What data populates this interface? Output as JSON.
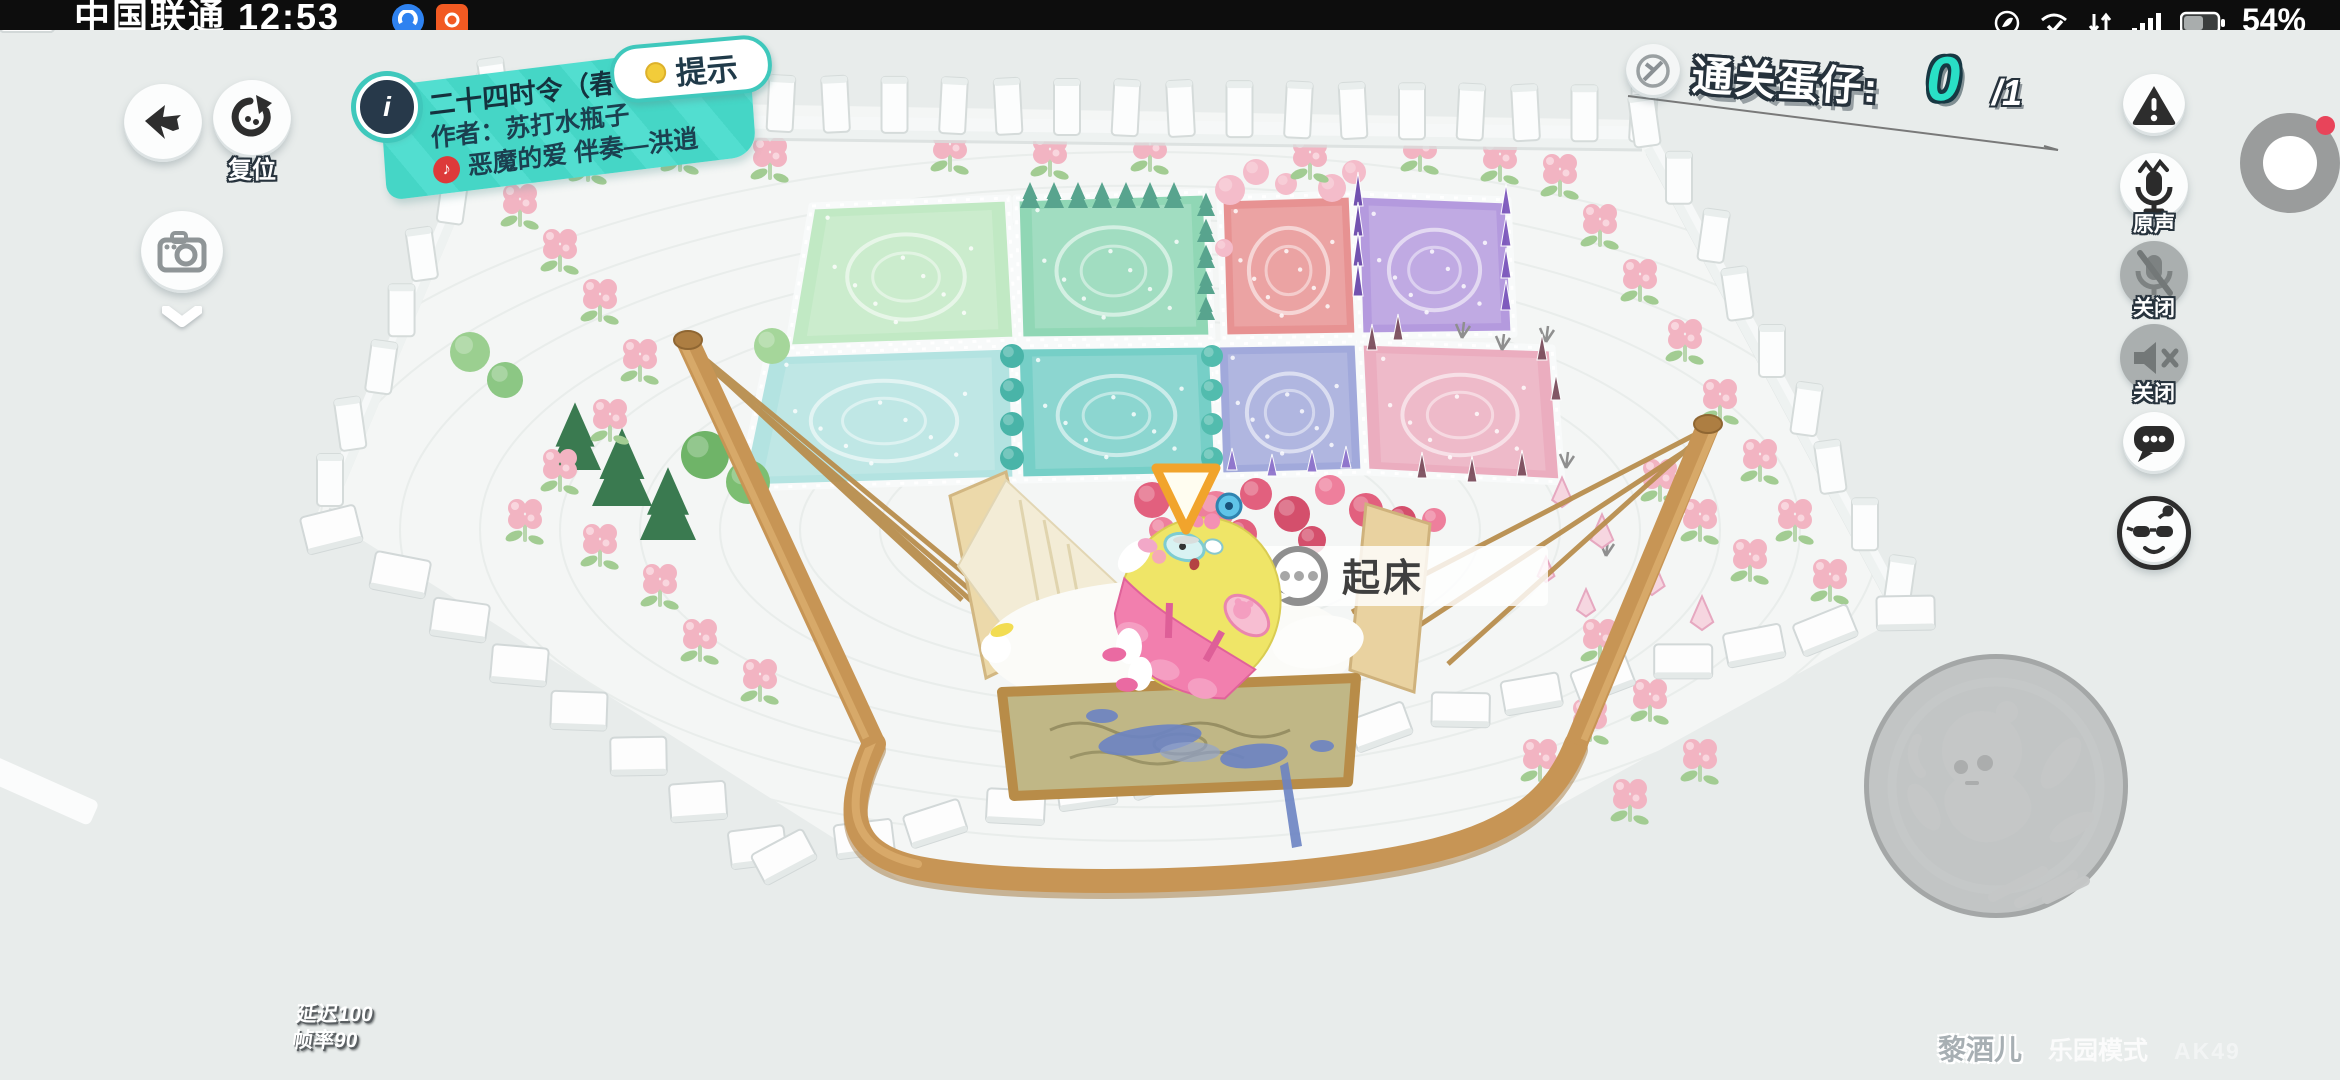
{
  "status_bar": {
    "carrier_time": "中国联通 12:53",
    "battery_percent": "54%"
  },
  "hud": {
    "reset_label": "复位",
    "hint_label": "提示",
    "map_banner": {
      "title": "二十四时令（春夏）",
      "author": "作者：苏打水瓶子",
      "music": "恶魔的爱 伴奏—洪逍"
    },
    "objective": {
      "label": "通关蛋仔:",
      "current": "0",
      "total": "/1"
    },
    "voice_panel": {
      "voice_label": "原声",
      "mic_label": "关闭",
      "speaker_label": "关闭"
    },
    "prompt_label": "起床",
    "debug": {
      "latency": "延迟100",
      "framerate": "帧率90"
    },
    "watermark": {
      "player": "黎酒儿",
      "mode": "乐园模式",
      "tag": "AK49"
    }
  },
  "colors": {
    "banner_teal": "#45d6c6",
    "counter_teal": "#29dfc6",
    "netease_red": "#dd3a3a",
    "wood": "#c79555",
    "marker_orange": "#f1a42c"
  },
  "icons": [
    "back-icon",
    "reset-icon",
    "info-icon",
    "hint-dot-icon",
    "camera-icon",
    "chevron-down-icon",
    "netease-music-icon",
    "objective-badge-icon",
    "warning-icon",
    "voice-mic-icon",
    "mic-off-icon",
    "speaker-off-icon",
    "chat-bubble-icon",
    "emote-face-icon",
    "screen-record-icon",
    "speech-bubble-icon",
    "waypoint-marker-icon",
    "action-egg-icon"
  ]
}
